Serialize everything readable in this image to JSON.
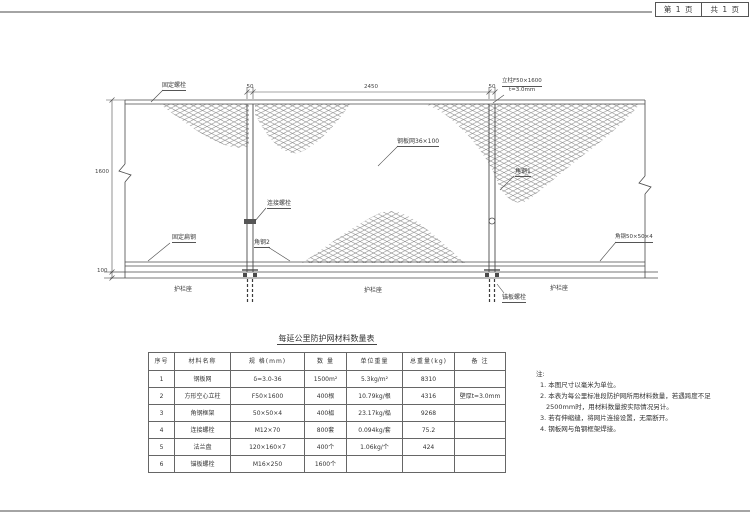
{
  "sheet": {
    "page_no": "第 1 页",
    "page_total": "共 1 页"
  },
  "drawing": {
    "dims": {
      "span": "2450",
      "post_width_left": "50",
      "post_width_right": "50",
      "fence_height": "1600",
      "base_height": "100"
    },
    "labels": {
      "fixing_bolt": "固定螺栓",
      "post_spec": "立柱F50×1600",
      "post_spec2": "t=3.0mm",
      "mesh": "钢板网36×100",
      "connect_bolt": "连接螺栓",
      "angle2": "角钢2",
      "fixing_flat": "固定扁钢",
      "angle1": "角钢1",
      "angle_spec": "角钢50×50×4",
      "anchor_bolt": "锚板螺栓",
      "seat_left": "护栏座",
      "seat_mid": "护栏座",
      "seat_right": "护栏座"
    }
  },
  "table": {
    "title": "每延公里防护网材料数量表",
    "headers": [
      "序号",
      "材料名称",
      "规  格(mm)",
      "数  量",
      "单位重量",
      "总重量(kg)",
      "备  注"
    ],
    "rows": [
      [
        "1",
        "钢板网",
        "δ=3.0-36",
        "1500m²",
        "5.3kg/m²",
        "8310",
        ""
      ],
      [
        "2",
        "方形空心立柱",
        "F50×1600",
        "400根",
        "10.79kg/根",
        "4316",
        "壁厚t=3.0mm"
      ],
      [
        "3",
        "角钢框架",
        "50×50×4",
        "400榀",
        "23.17kg/榀",
        "9268",
        ""
      ],
      [
        "4",
        "连接螺栓",
        "M12×70",
        "800套",
        "0.094kg/套",
        "75.2",
        ""
      ],
      [
        "5",
        "法兰盘",
        "120×160×7",
        "400个",
        "1.06kg/个",
        "424",
        ""
      ],
      [
        "6",
        "锚板螺栓",
        "M16×250",
        "1600个",
        "",
        "",
        ""
      ]
    ]
  },
  "notes": {
    "title": "注:",
    "items": [
      "1. 本图尺寸以毫米为单位。",
      "2. 本表为每公里标准段防护网所用材料数量，若遇跨度不足2500mm时，用材料数量按实际情况另计。",
      "3. 若有伸缩缝，将网片连接设置，无需断开。",
      "4. 钢板网与角钢框架焊接。"
    ]
  },
  "colors": {
    "line": "#4a4a4a",
    "mesh": "#7a7a7a",
    "text": "#333333",
    "paper": "#ffffff"
  }
}
